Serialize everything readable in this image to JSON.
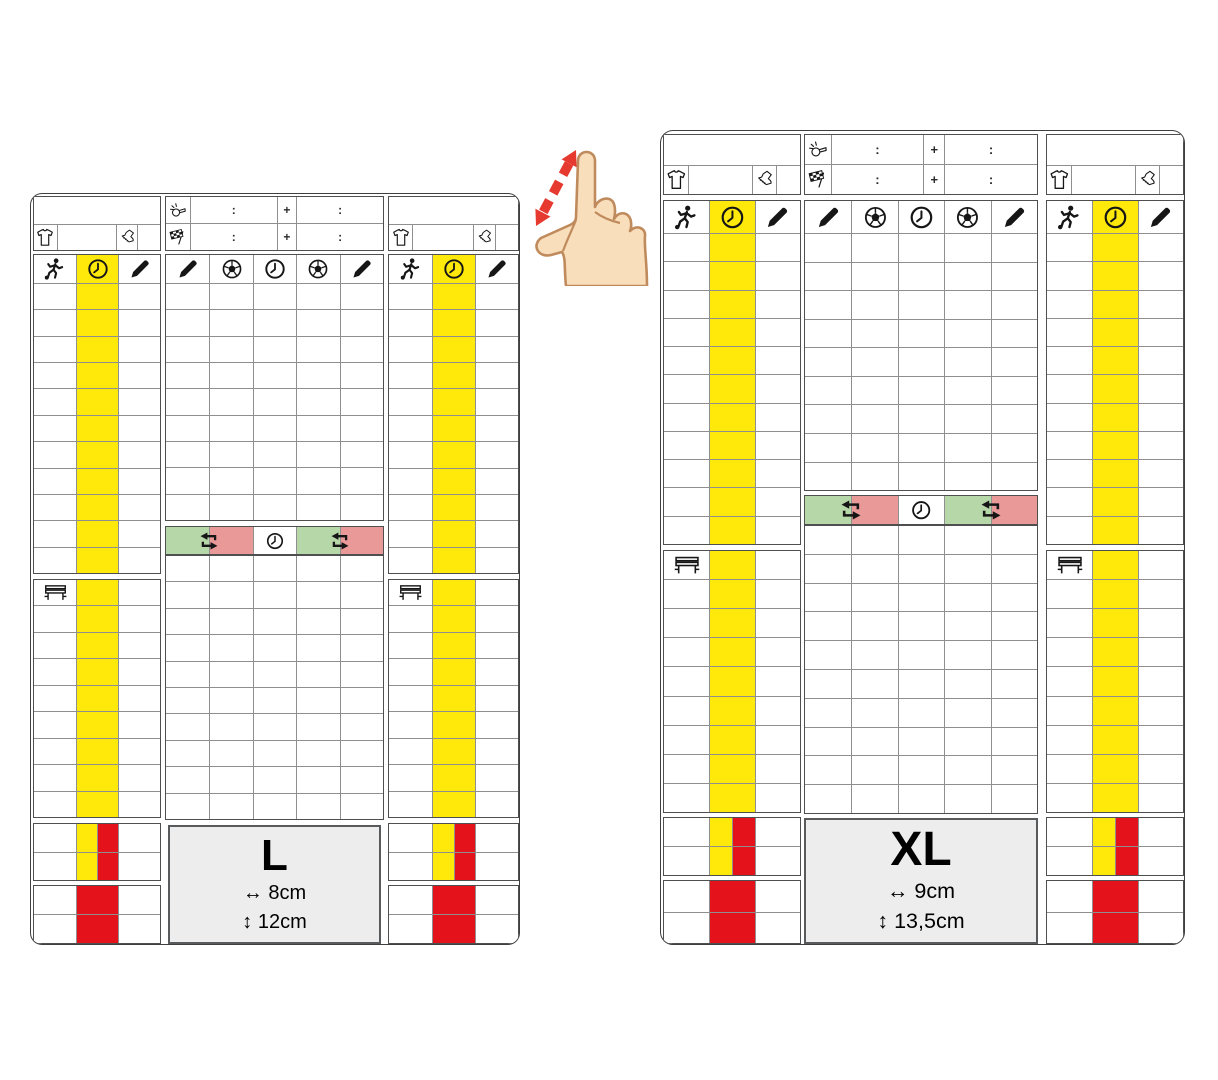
{
  "illustration": {
    "name": "referee-card-size-comparison",
    "gesture_name": "pinch-zoom-gesture"
  },
  "cards": [
    {
      "id": "card-l",
      "size_label": "L",
      "width_label": "↔ 8cm",
      "height_label": "↕ 12cm"
    },
    {
      "id": "card-xl",
      "size_label": "XL",
      "width_label": "↔ 9cm",
      "height_label": "↕ 13,5cm"
    }
  ],
  "score_header": {
    "colon": ":",
    "plus": "+",
    "row1_icon": "whistle-icon",
    "row2_icon": "flag-icon"
  },
  "team_panel": {
    "header_icons": [
      "player-icon",
      "clock-icon",
      "pencil-icon"
    ],
    "info_icons": [
      "shirt-icon",
      "boot-icon"
    ],
    "bench_icon": "bench-icon"
  },
  "score_panel": {
    "header_icons": [
      "pencil-icon",
      "ball-icon",
      "clock-icon",
      "ball-icon",
      "pencil-icon"
    ],
    "substitution_icons": [
      "swap-icon",
      "clock-icon",
      "swap-icon"
    ]
  },
  "colors": {
    "yellow": "#ffe90a",
    "red": "#e3121b",
    "sub_green": "#b6d7a8",
    "sub_pink": "#ea9999",
    "box_bg": "#ededed",
    "box_border": "#595a5c",
    "grid_line": "#8f8f8f",
    "block_border": "#4f4f4f",
    "card_border": "#3f3f3f",
    "icon": "#161616",
    "gesture_arrow": "#e6392f",
    "hand_fill": "#f9debc",
    "hand_outline": "#c08b5c"
  }
}
